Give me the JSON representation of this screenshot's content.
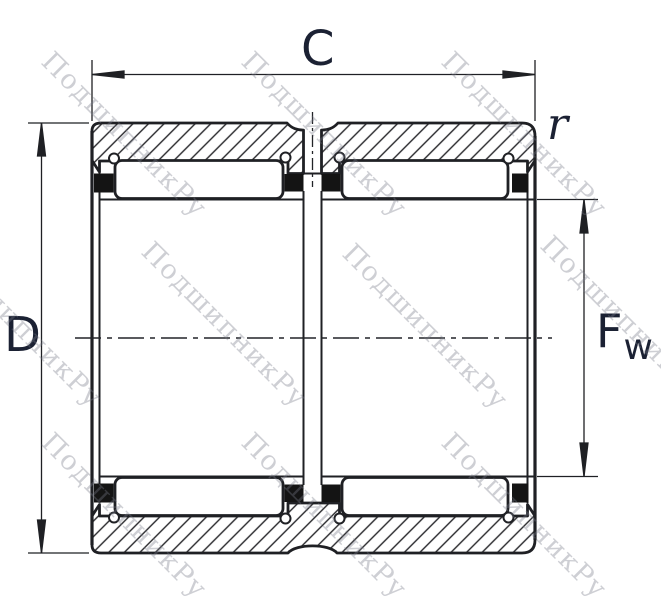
{
  "drawing": {
    "title": "Double-row needle roller bearing cross-section",
    "labels": {
      "width": "C",
      "outer_diameter": "D",
      "corner_radius": "r",
      "bore_main": "F",
      "bore_sub": "w"
    },
    "watermark": {
      "text": "ПодшипникРу"
    },
    "colors": {
      "line": "#1f2024",
      "label": "#1b2133",
      "cage_block": "#141414",
      "hatch_line": "#26262a",
      "watermark": "rgba(118,122,136,0.36)"
    }
  }
}
